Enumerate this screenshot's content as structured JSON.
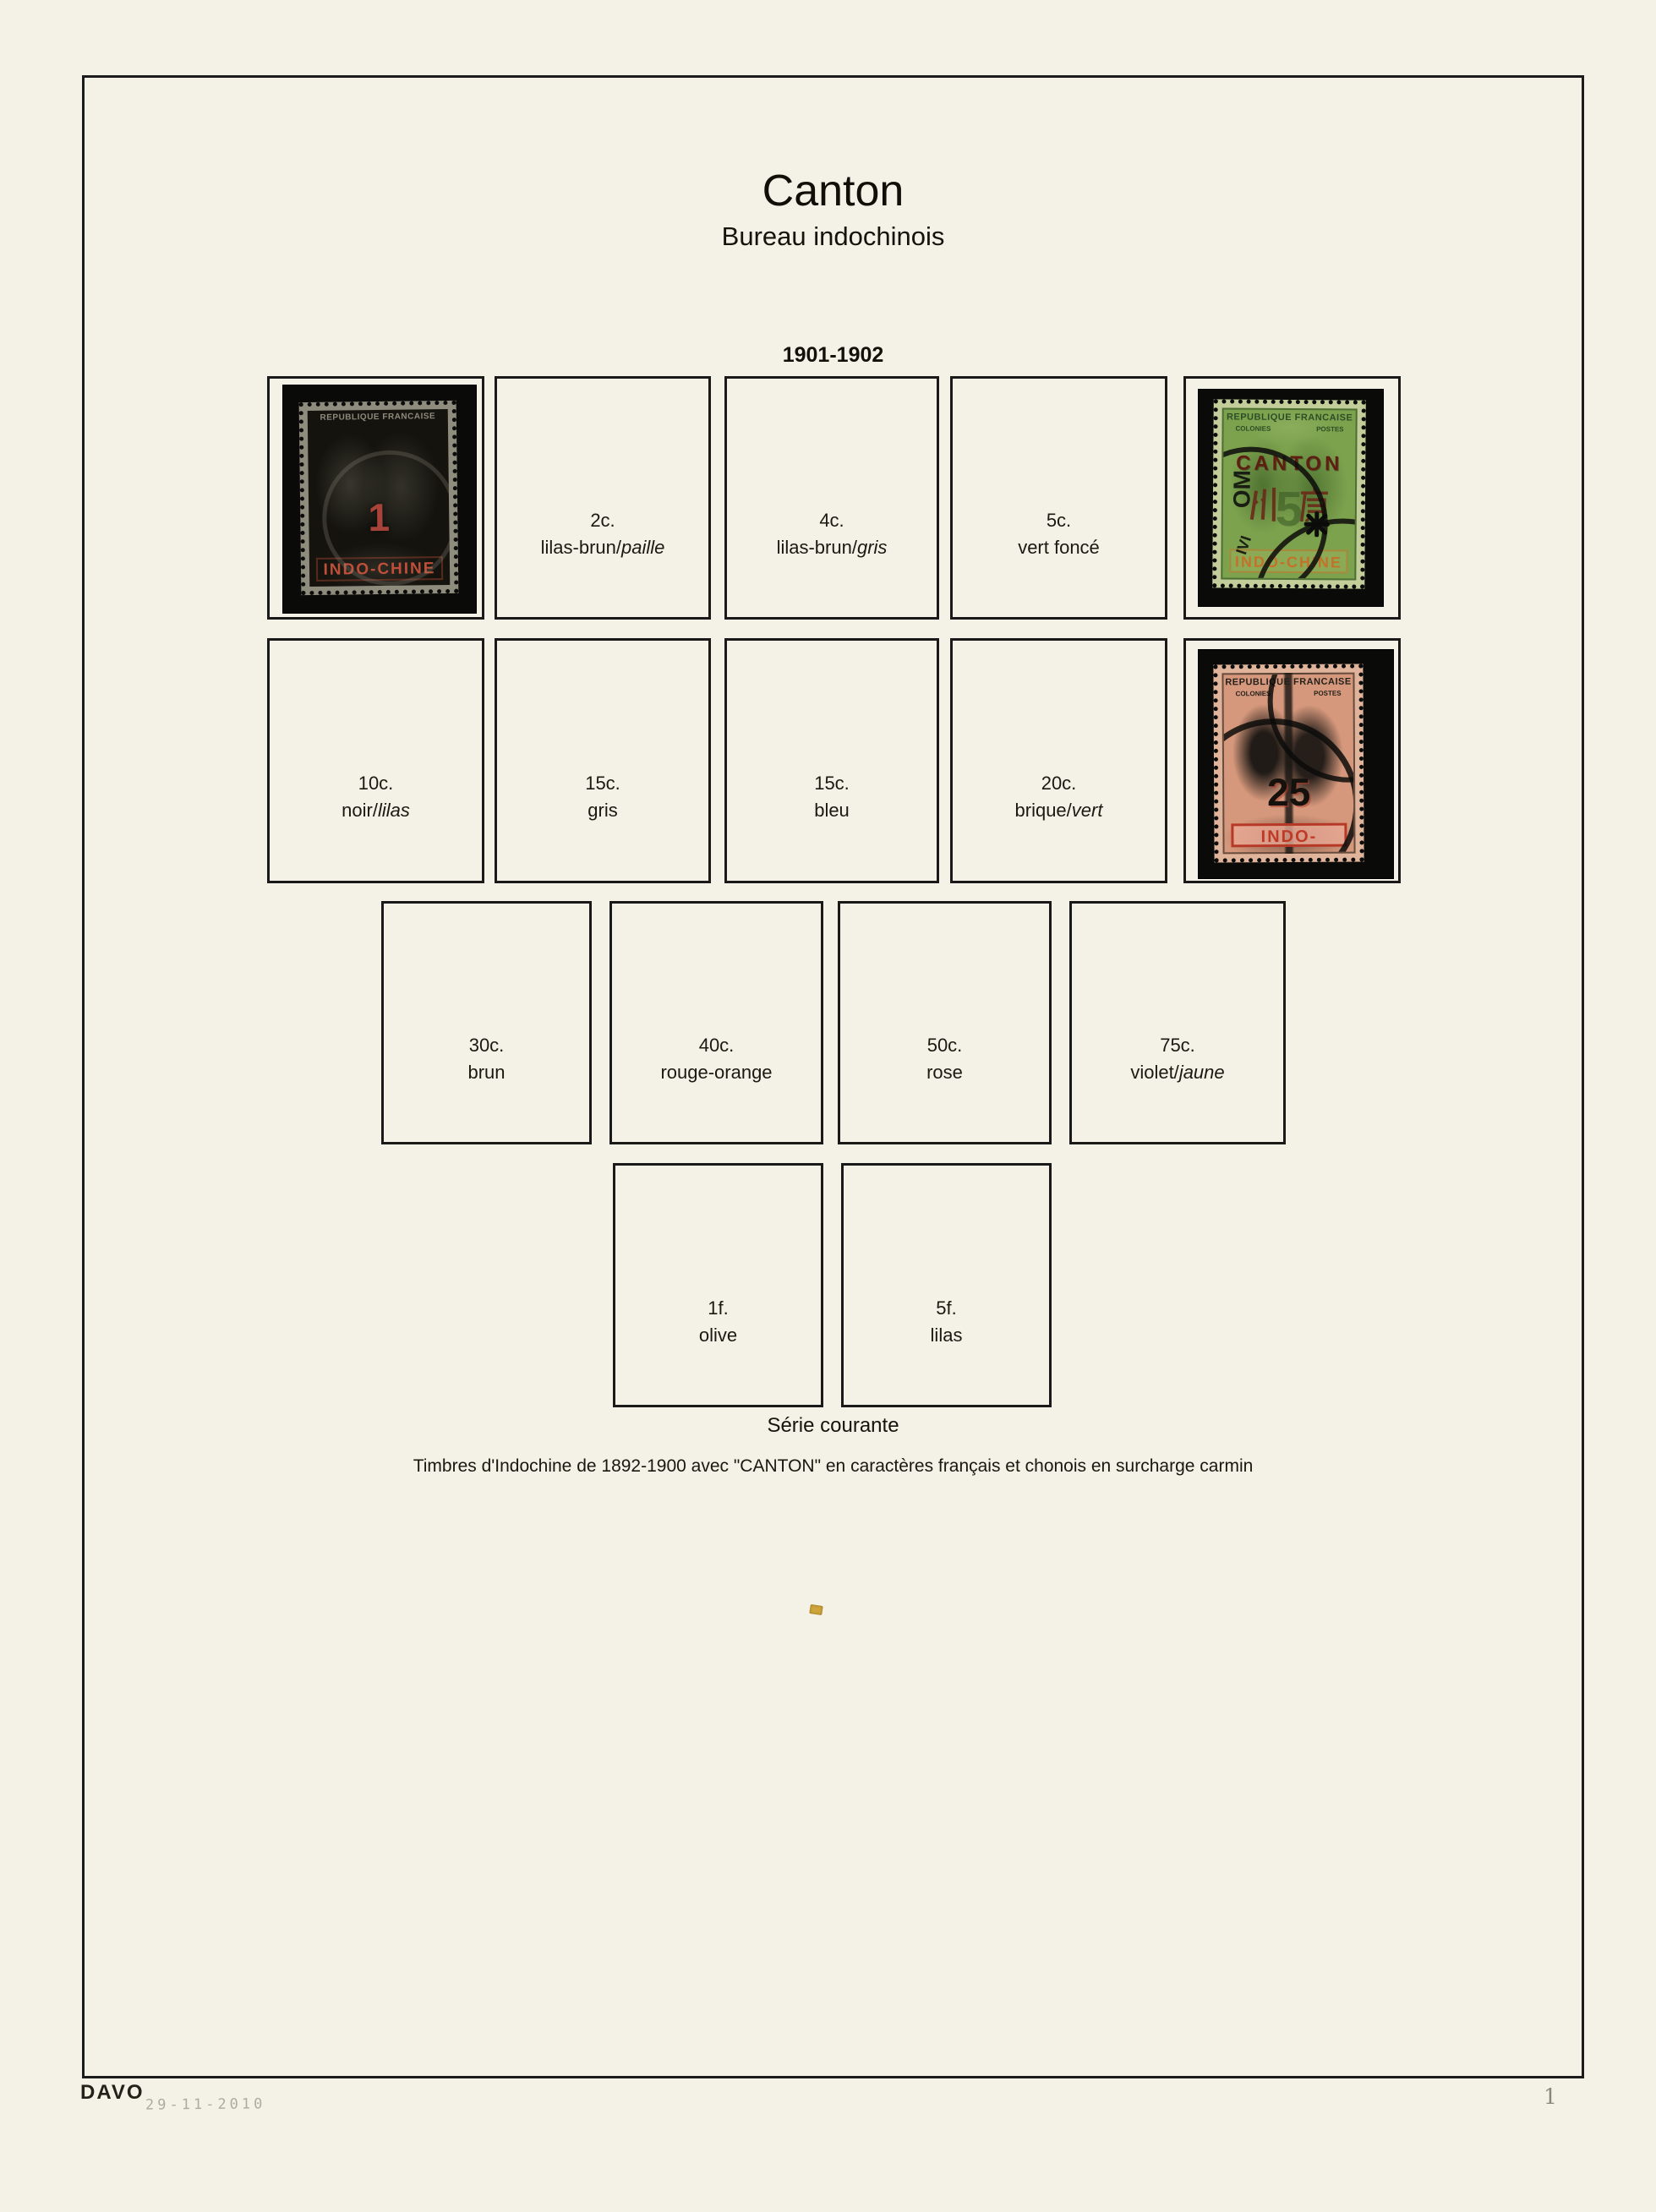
{
  "page": {
    "title": "Canton",
    "subtitle": "Bureau indochinois",
    "section_heading": "1901-1902",
    "caption_title": "Série courante",
    "caption_line": "Timbres d'Indochine de 1892-1900 avec \"CANTON\" en caractères français et chonois en surcharge carmin",
    "publisher_mark": "DAVO",
    "date_stamp": "29-11-2010",
    "page_number": "1"
  },
  "boxes": [
    {
      "value": "2c.",
      "color": "lilas-brun/",
      "color_em": "paille"
    },
    {
      "value": "4c.",
      "color": "lilas-brun/",
      "color_em": "gris"
    },
    {
      "value": "5c.",
      "color": "vert foncé",
      "color_em": ""
    },
    {
      "value": "10c.",
      "color": "noir/",
      "color_em": "lilas"
    },
    {
      "value": "15c.",
      "color": "gris",
      "color_em": ""
    },
    {
      "value": "15c.",
      "color": "bleu",
      "color_em": ""
    },
    {
      "value": "20c.",
      "color": "brique/",
      "color_em": "vert"
    },
    {
      "value": "30c.",
      "color": "brun",
      "color_em": ""
    },
    {
      "value": "40c.",
      "color": "rouge-orange",
      "color_em": ""
    },
    {
      "value": "50c.",
      "color": "rose",
      "color_em": ""
    },
    {
      "value": "75c.",
      "color": "violet/",
      "color_em": "jaune"
    },
    {
      "value": "1f.",
      "color": "olive",
      "color_em": ""
    },
    {
      "value": "5f.",
      "color": "lilas",
      "color_em": ""
    }
  ],
  "stamps": {
    "c1": {
      "top_text": "REPUBLIQUE FRANCAISE",
      "value": "1",
      "country": "INDO-CHINE"
    },
    "c5": {
      "top_text": "REPUBLIQUE FRANCAISE",
      "colonies": "COLONIES",
      "postes": "POSTES",
      "overprint": "CANTON",
      "overprint_cn": "州廣",
      "value": "5",
      "country": "INDO-CHINE",
      "cancel_left": "OM",
      "cancel_bottom": "IVI"
    },
    "c25": {
      "top_text": "REPUBLIQUE FRANCAISE",
      "colonies": "COLONIES",
      "postes": "POSTES",
      "value": "25",
      "country": "INDO-CHINE"
    }
  }
}
